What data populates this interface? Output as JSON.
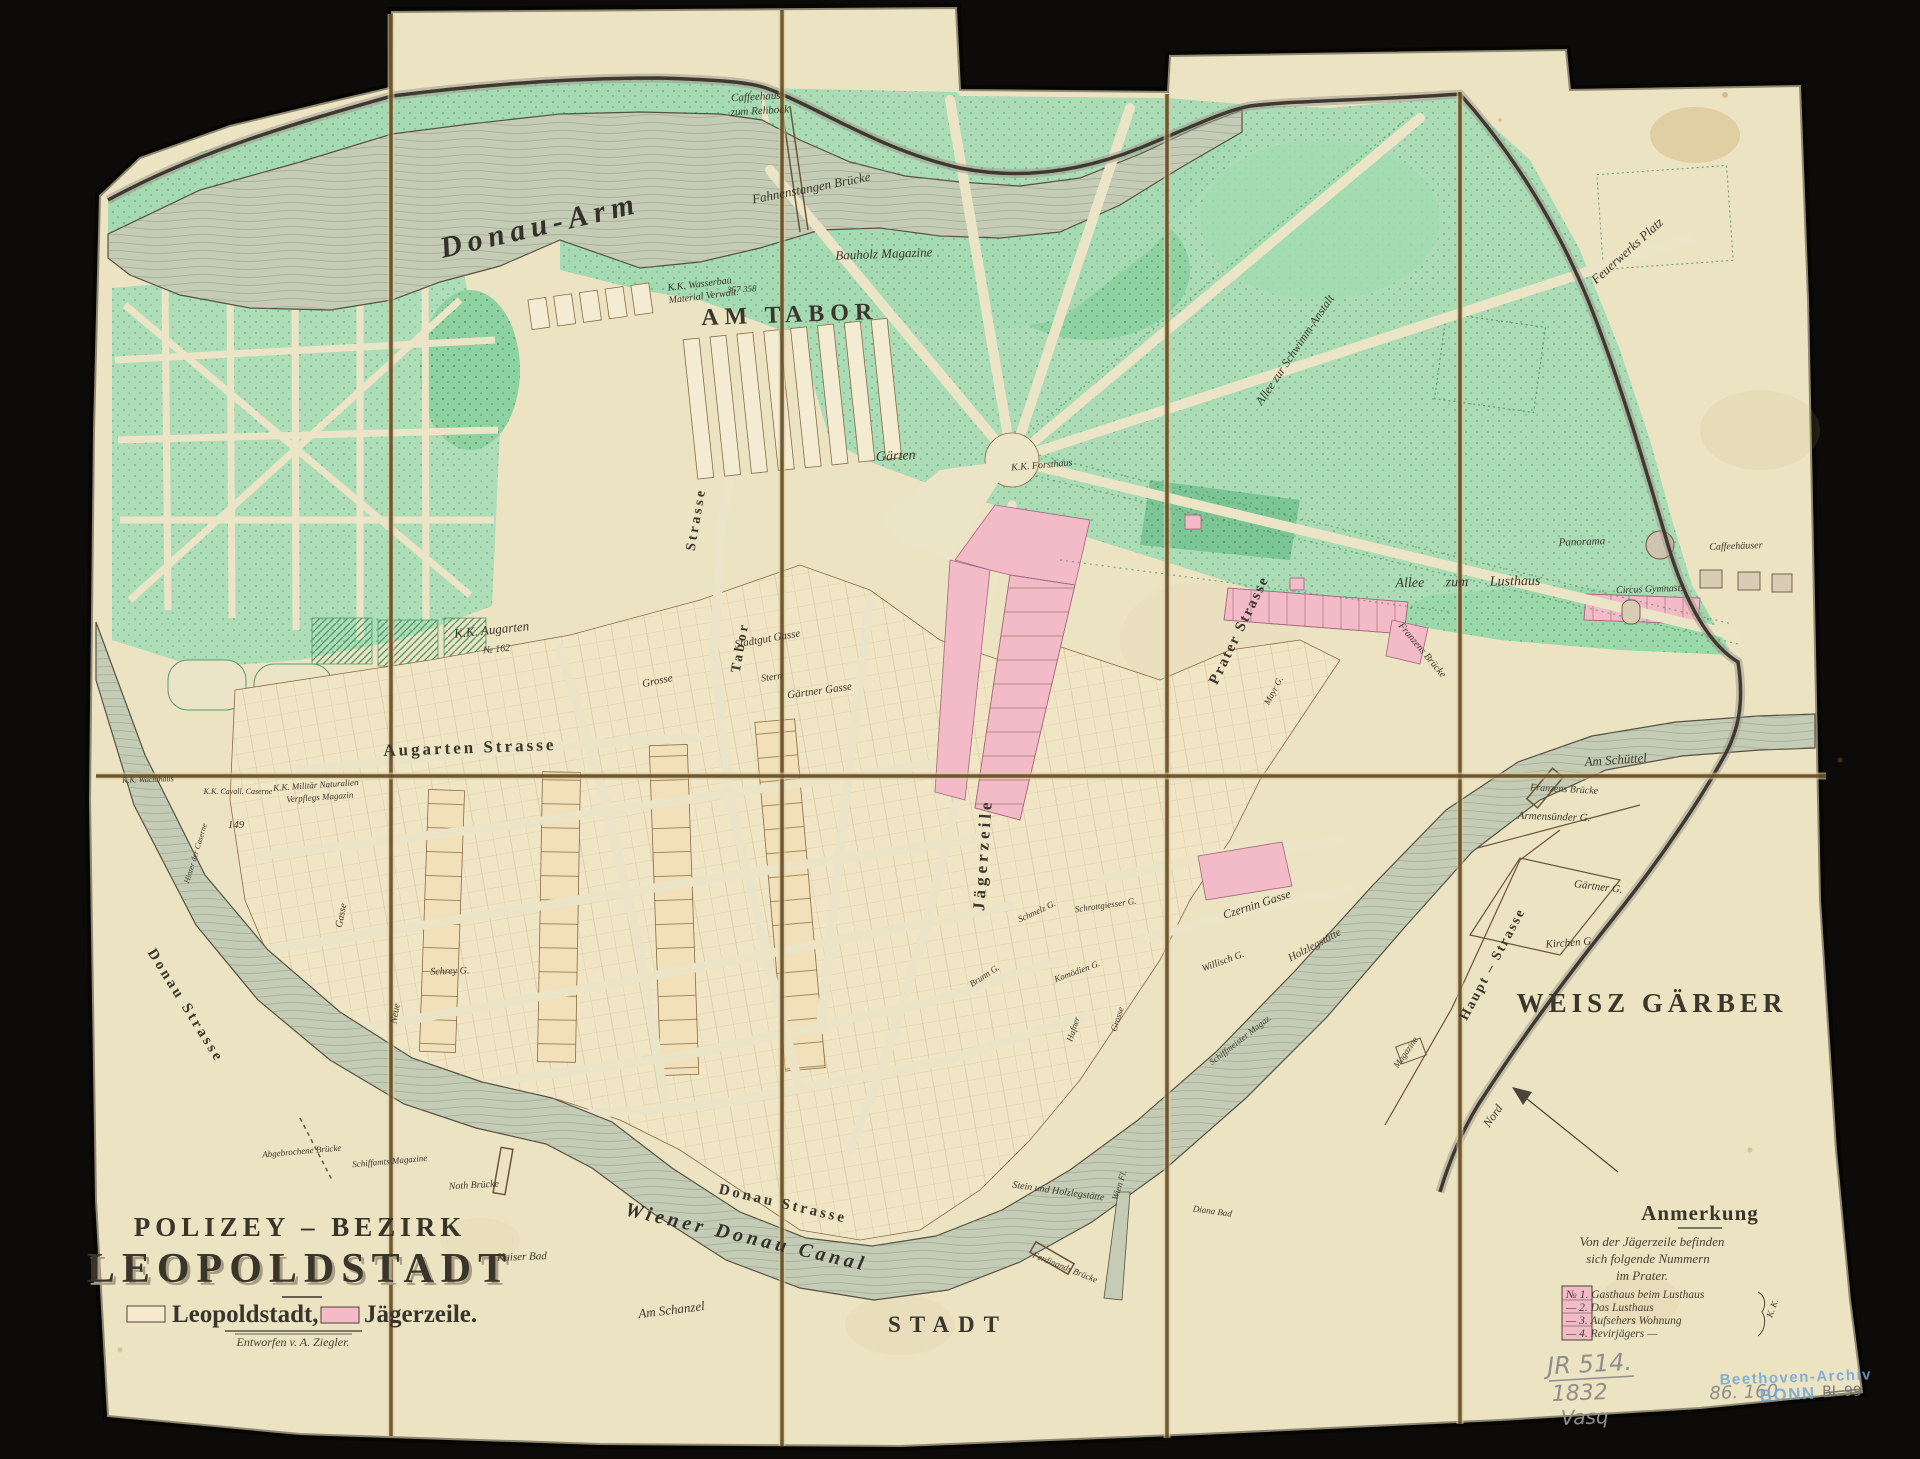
{
  "canvas": {
    "width": 1920,
    "height": 1459,
    "mount_color": "#0d0b09",
    "paper_color": "#ece3c3"
  },
  "colors": {
    "leopoldstadt": "#f6e9cd",
    "jaegerzeile": "#f3bac8",
    "park_green": "#abdcb6",
    "water": "#c5ccb5",
    "ink": "#3c372c",
    "stamp_blue": "#6fa8d8",
    "pencil_grey": "#8f8e8b"
  },
  "title_block": {
    "line1": "POLIZEY – BEZIRK",
    "line2": "LEOPOLDSTADT",
    "legend": [
      {
        "label": "Leopoldstadt,",
        "swatch": "#f6e9cd"
      },
      {
        "label": "Jägerzeile.",
        "swatch": "#f3bac8"
      }
    ],
    "credit": "Entworfen v. A. Ziegler."
  },
  "note_block": {
    "heading": "Anmerkung",
    "intro": [
      "Von der Jägerzeile befinden",
      "sich folgende Nummern",
      "im Prater."
    ],
    "items": [
      "№ 1. Gasthaus beim Lusthaus",
      "—  2. Das Lusthaus",
      "—  3. Aufsehers Wohnung",
      "—  4. Revirjägers  —"
    ],
    "bracket_label": "K. K.",
    "swatch": "#f3bac8"
  },
  "annotations": {
    "pencil_id": "JR 514.",
    "pencil_year": "1832",
    "pencil_word": "Vasq",
    "pencil_number": "86. 160",
    "stamp_line1": "Beethoven-Archiv",
    "stamp_line2": "BONN",
    "stamp_crossed": "BL 99"
  },
  "map_labels": [
    {
      "t": "AM TABOR",
      "x": 790,
      "y": 322,
      "s": 24,
      "r": -2,
      "c": "caps",
      "ls": 6
    },
    {
      "t": "WEISZ GÄRBER",
      "x": 1652,
      "y": 1012,
      "s": 27,
      "r": 0,
      "c": "caps",
      "ls": 5
    },
    {
      "t": "STADT",
      "x": 948,
      "y": 1332,
      "s": 23,
      "r": 0,
      "c": "caps",
      "ls": 9
    },
    {
      "t": "Augarten Strasse",
      "x": 470,
      "y": 753,
      "s": 17,
      "r": -2,
      "c": "caps2",
      "ls": 3
    },
    {
      "t": "Donau Strasse",
      "x": 782,
      "y": 1208,
      "s": 15,
      "r": 13,
      "c": "caps2",
      "ls": 3
    },
    {
      "t": "Donau Strasse",
      "x": 182,
      "y": 1008,
      "s": 15,
      "r": 58,
      "c": "caps2",
      "ls": 3
    },
    {
      "t": "Jägerzeile",
      "x": 988,
      "y": 855,
      "s": 17,
      "r": -86,
      "c": "caps2",
      "ls": 4
    },
    {
      "t": "Prater Strasse",
      "x": 1243,
      "y": 632,
      "s": 15,
      "r": -64,
      "c": "caps2",
      "ls": 2
    },
    {
      "t": "Haupt – Strasse",
      "x": 1496,
      "y": 966,
      "s": 14,
      "r": -62,
      "c": "caps2",
      "ls": 2
    },
    {
      "t": "Tabor",
      "x": 744,
      "y": 648,
      "s": 14,
      "r": -80,
      "c": "caps2",
      "ls": 3
    },
    {
      "t": "Strasse",
      "x": 700,
      "y": 520,
      "s": 14,
      "r": -80,
      "c": "caps2",
      "ls": 3
    },
    {
      "t": "Donau-Arm",
      "x": 542,
      "y": 235,
      "s": 30,
      "r": -13,
      "c": "bigit",
      "ls": 6
    },
    {
      "t": "Wiener Donau Canal",
      "x": 745,
      "y": 1243,
      "s": 20,
      "r": 13,
      "c": "bigit",
      "ls": 4
    },
    {
      "t": "Fahnenstangen Brücke",
      "x": 812,
      "y": 192,
      "s": 13,
      "r": -11
    },
    {
      "t": "Caffeehaus",
      "x": 756,
      "y": 100,
      "s": 11,
      "r": -3
    },
    {
      "t": "zum Rehbock",
      "x": 760,
      "y": 114,
      "s": 11,
      "r": -3
    },
    {
      "t": "K.K. Wasserbau",
      "x": 700,
      "y": 287,
      "s": 10,
      "r": -7
    },
    {
      "t": "Material Verwalt.",
      "x": 704,
      "y": 299,
      "s": 10,
      "r": -7
    },
    {
      "t": "Bauholz Magazine",
      "x": 884,
      "y": 258,
      "s": 13,
      "r": -2
    },
    {
      "t": "Gärten",
      "x": 896,
      "y": 460,
      "s": 14,
      "r": -3
    },
    {
      "t": "K.K. Forsthaus",
      "x": 1042,
      "y": 468,
      "s": 10,
      "r": -5
    },
    {
      "t": "Allee zur Schwimm-Anstalt",
      "x": 1298,
      "y": 352,
      "s": 12,
      "r": -56
    },
    {
      "t": "Feuerwerks Platz",
      "x": 1630,
      "y": 254,
      "s": 13,
      "r": -42
    },
    {
      "t": "Panorama",
      "x": 1582,
      "y": 545,
      "s": 11,
      "r": -2
    },
    {
      "t": "Caffeehäuser",
      "x": 1736,
      "y": 549,
      "s": 10,
      "r": -2
    },
    {
      "t": "Allee   zum   Lusthaus",
      "x": 1468,
      "y": 586,
      "s": 14,
      "r": -1,
      "ws": 18
    },
    {
      "t": "Circus Gymnast:",
      "x": 1650,
      "y": 592,
      "s": 10,
      "r": -2
    },
    {
      "t": "Am Schüttel",
      "x": 1616,
      "y": 764,
      "s": 13,
      "r": -4
    },
    {
      "t": "Franzens Brücke",
      "x": 1564,
      "y": 792,
      "s": 10,
      "r": 3
    },
    {
      "t": "Armensünder G.",
      "x": 1554,
      "y": 820,
      "s": 11,
      "r": 2
    },
    {
      "t": "Gärtner G.",
      "x": 1598,
      "y": 890,
      "s": 11,
      "r": 7
    },
    {
      "t": "Kirchen G.",
      "x": 1570,
      "y": 946,
      "s": 11,
      "r": -4
    },
    {
      "t": "Nord",
      "x": 1496,
      "y": 1118,
      "s": 12,
      "r": -55
    },
    {
      "t": "Am Schanzel",
      "x": 672,
      "y": 1314,
      "s": 13,
      "r": -7
    },
    {
      "t": "Kaiser Bad",
      "x": 522,
      "y": 1260,
      "s": 11,
      "r": -2
    },
    {
      "t": "Noth Brücke",
      "x": 474,
      "y": 1188,
      "s": 10,
      "r": -3
    },
    {
      "t": "Diana Bad",
      "x": 1212,
      "y": 1214,
      "s": 9,
      "r": 8
    },
    {
      "t": "Ferdinands Brücke",
      "x": 1064,
      "y": 1270,
      "s": 9,
      "r": 22
    },
    {
      "t": "Wien Fl.",
      "x": 1122,
      "y": 1186,
      "s": 9,
      "r": -72
    },
    {
      "t": "K.K. Augarten",
      "x": 492,
      "y": 634,
      "s": 13,
      "r": -6
    },
    {
      "t": "№ 162",
      "x": 497,
      "y": 652,
      "s": 10,
      "r": -6
    },
    {
      "t": "K.K. Cavall. Caserne",
      "x": 238,
      "y": 794,
      "s": 8,
      "r": 0
    },
    {
      "t": "K.K. Wachthaus",
      "x": 148,
      "y": 782,
      "s": 8,
      "r": -2
    },
    {
      "t": "Hinter der Caserne",
      "x": 198,
      "y": 854,
      "s": 8,
      "r": -73
    },
    {
      "t": "K.K. Militär Naturalien",
      "x": 316,
      "y": 788,
      "s": 9,
      "r": -4
    },
    {
      "t": "Verpflegs Magazin",
      "x": 320,
      "y": 800,
      "s": 9,
      "r": -4
    },
    {
      "t": "Schrey G.",
      "x": 450,
      "y": 974,
      "s": 10,
      "r": -2
    },
    {
      "t": "Neue",
      "x": 398,
      "y": 1014,
      "s": 10,
      "r": -80
    },
    {
      "t": "Gasse",
      "x": 344,
      "y": 916,
      "s": 10,
      "r": -78
    },
    {
      "t": "Stadtgut Gasse",
      "x": 768,
      "y": 642,
      "s": 11,
      "r": -10
    },
    {
      "t": "Grosse",
      "x": 658,
      "y": 684,
      "s": 11,
      "r": -12
    },
    {
      "t": "Gärtner Gasse",
      "x": 820,
      "y": 694,
      "s": 11,
      "r": -8
    },
    {
      "t": "Stern",
      "x": 772,
      "y": 680,
      "s": 10,
      "r": -8
    },
    {
      "t": "Czernin Gasse",
      "x": 1258,
      "y": 908,
      "s": 12,
      "r": -18
    },
    {
      "t": "Willisch G.",
      "x": 1224,
      "y": 964,
      "s": 10,
      "r": -20
    },
    {
      "t": "Holzlegstätte",
      "x": 1316,
      "y": 948,
      "s": 11,
      "r": -28
    },
    {
      "t": "Schmelz G.",
      "x": 1038,
      "y": 914,
      "s": 9,
      "r": -25
    },
    {
      "t": "Schrottgiesser G.",
      "x": 1106,
      "y": 908,
      "s": 9,
      "r": -8
    },
    {
      "t": "Brunn G.",
      "x": 986,
      "y": 978,
      "s": 9,
      "r": -33
    },
    {
      "t": "Komödien G.",
      "x": 1078,
      "y": 974,
      "s": 9,
      "r": -20
    },
    {
      "t": "Schiffmeister Magaz.",
      "x": 1242,
      "y": 1042,
      "s": 9,
      "r": -38
    },
    {
      "t": "Stein und Holzlegstätte",
      "x": 1058,
      "y": 1194,
      "s": 10,
      "r": 8
    },
    {
      "t": "Abgebrochene Brücke",
      "x": 302,
      "y": 1154,
      "s": 9,
      "r": -5
    },
    {
      "t": "Schiffamts Magazine",
      "x": 390,
      "y": 1164,
      "s": 9,
      "r": -5
    },
    {
      "t": "Magazine",
      "x": 1408,
      "y": 1054,
      "s": 9,
      "r": -55
    },
    {
      "t": "Franzens Brücke",
      "x": 1420,
      "y": 652,
      "s": 10,
      "r": 50
    },
    {
      "t": "Mayr G.",
      "x": 1276,
      "y": 692,
      "s": 9,
      "r": -62
    },
    {
      "t": "Hafner",
      "x": 1076,
      "y": 1030,
      "s": 9,
      "r": -72
    },
    {
      "t": "Grosse",
      "x": 1120,
      "y": 1020,
      "s": 9,
      "r": -72
    },
    {
      "t": "149",
      "x": 236,
      "y": 828,
      "s": 11,
      "r": 0,
      "c": "num"
    },
    {
      "t": "357  358",
      "x": 742,
      "y": 292,
      "s": 9,
      "r": -3,
      "c": "num"
    }
  ]
}
